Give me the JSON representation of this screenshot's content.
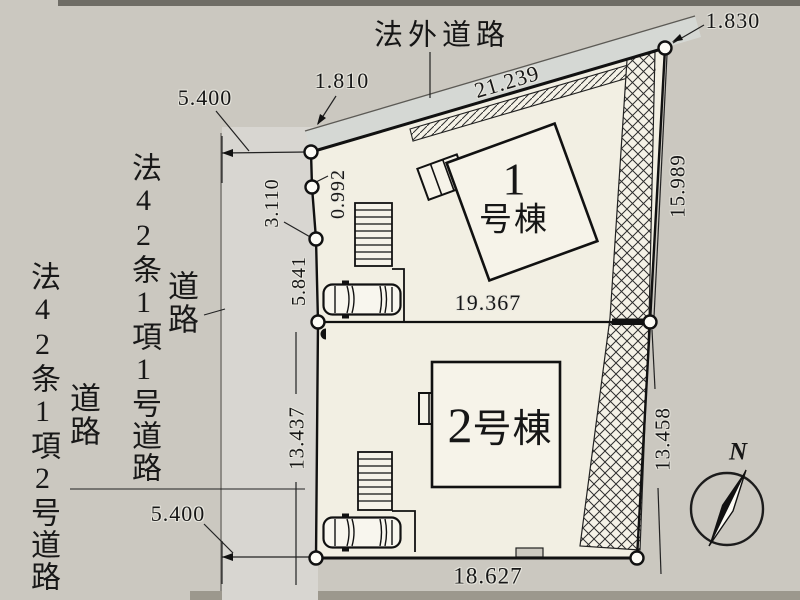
{
  "plan": {
    "roads": {
      "top_road_label": "法外道路",
      "left_road_upper_label": "法42条1項1号道路",
      "left_road_upper_sub": "道路",
      "left_road_lower_label": "法42条1項2号道路",
      "left_road_lower_sub": "道路"
    },
    "buildings": [
      {
        "num": "1",
        "suffix": "号棟"
      },
      {
        "num": "2",
        "suffix": "号棟"
      }
    ],
    "dimensions": {
      "top_road_width": "5.400",
      "front_left": "1.810",
      "top_edge": "21.239",
      "front_right": "1.830",
      "right_upper": "15.989",
      "right_lower": "13.458",
      "center_width": "19.367",
      "bottom_width": "18.627",
      "left_lower": "13.437",
      "left_seg_small": "0.992",
      "left_seg_mid": "3.110",
      "left_seg_low": "5.841",
      "bottom_road_width": "5.400"
    },
    "compass": {
      "north": "N"
    },
    "colors": {
      "background": "#cbc8c0",
      "lot_fill": "#f2efe3",
      "left_road_fill": "#d8d6d1",
      "top_road_fill": "#d5d8d4",
      "building_fill": "#f6f3e9",
      "line": "#1a1a1a"
    }
  }
}
